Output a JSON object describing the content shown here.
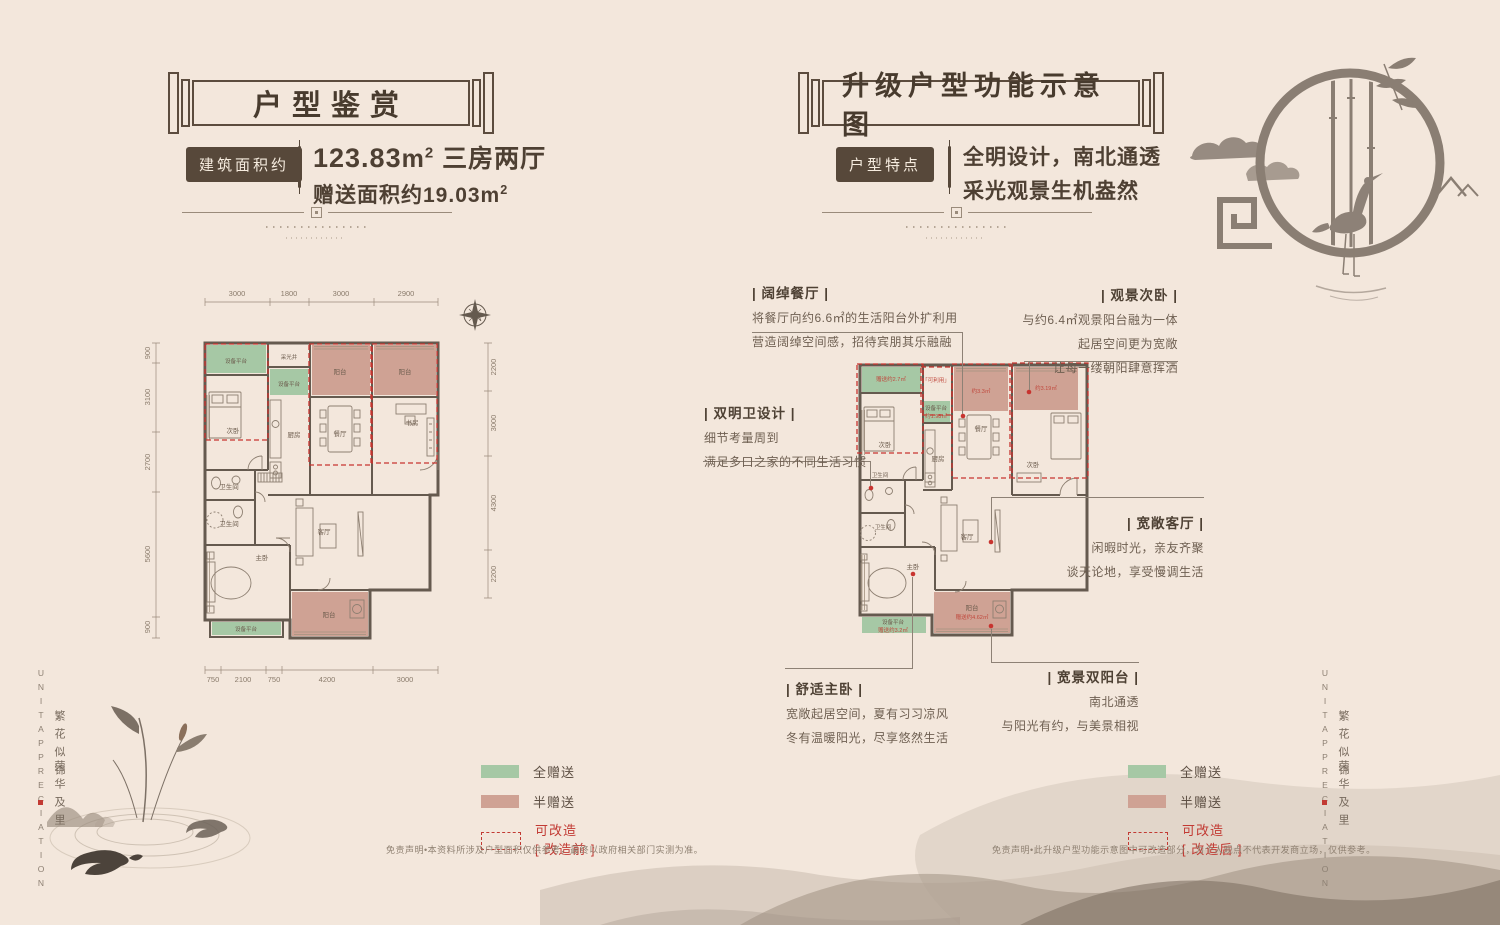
{
  "colors": {
    "background": "#f3e7dc",
    "accent_red": "#c23a33",
    "gift_green": "#a6c8a5",
    "gift_pink": "#cfa294",
    "dark_brown": "#554637"
  },
  "side_left": {
    "en": "UNITAPPRECIATION",
    "cn_top": "繁花似锦",
    "cn_bottom": "荣华及里"
  },
  "side_right": {
    "en": "UNITAPPRECIATION",
    "cn_top": "繁花似锦",
    "cn_bottom": "荣华及里"
  },
  "left_panel": {
    "banner_title": "户型鉴赏",
    "info": {
      "label": "建筑面积约",
      "area_value": "123.83",
      "area_unit": "m",
      "area_sup": "2",
      "area_rest": "三房两厅",
      "gift_line": "赠送面积约19.03m",
      "gift_sup": "2"
    },
    "plan": {
      "dims_top": [
        "3000",
        "1800",
        "3000",
        "2900"
      ],
      "dims_bottom": [
        "750",
        "2100",
        "750",
        "4200",
        "3000"
      ],
      "dims_left": [
        "900",
        "3100",
        "2700",
        "5600",
        "900"
      ],
      "dims_right": [
        "2200",
        "3000",
        "4300",
        "2200"
      ],
      "rooms": {
        "equip_top": "设备平台",
        "skylight": "采光井",
        "equip_mid": "设备平台",
        "balcony_center": "阳台",
        "balcony_right": "阳台",
        "bedroom2": "次卧",
        "kitchen": "厨房",
        "dining": "餐厅",
        "study": "书房",
        "bath_upper": "卫生间",
        "bath_lower": "卫生间",
        "master": "主卧",
        "living": "客厅",
        "balcony_bottom": "阳台",
        "equip_bottom": "设备平台"
      }
    },
    "legend": {
      "full": "全赠送",
      "half": "半赠送",
      "mod": "可改造",
      "mod_state": "[ 改造前 ]"
    },
    "disclaimer": "免责声明•本资料所涉及户型面积仅供参考，最终以政府相关部门实测为准。"
  },
  "right_panel": {
    "banner_title": "升级户型功能示意图",
    "info": {
      "label": "户型特点",
      "line1": "全明设计，南北通透",
      "line2": "采光观景生机盎然"
    },
    "plan": {
      "rooms": {
        "gift_27": "赠送约2.7㎡",
        "usable": "「可利用」",
        "equip": "设备平台",
        "equip_area": "约1.98㎡",
        "kitchen": "厨房",
        "dining_gift": "约3.3㎡",
        "dining": "餐厅",
        "bedroom2_left": "次卧",
        "bedroom2_gift": "约3.19㎡",
        "bedroom2_right": "次卧",
        "bath_upper": "卫生间",
        "bath_lower": "卫生间",
        "master": "主卧",
        "living": "客厅",
        "balcony": "阳台",
        "balcony_gift": "赠送约4.62㎡",
        "equip_bottom": "设备平台",
        "equip_bottom_gift": "赠送约3.2㎡"
      }
    },
    "annotations": {
      "dining": {
        "title": "| 阔绰餐厅 |",
        "line1": "将餐厅向约6.6㎡的生活阳台外扩利用",
        "line2": "营造阔绰空间感，招待宾朋其乐融融"
      },
      "bedroom": {
        "title": "| 观景次卧 |",
        "line1": "与约6.4㎡观景阳台融为一体",
        "line2": "起居空间更为宽敞",
        "line3": "让每一缕朝阳肆意挥洒"
      },
      "bath": {
        "title": "| 双明卫设计 |",
        "line1": "细节考量周到",
        "line2": "满足多口之家的不同生活习惯"
      },
      "living": {
        "title": "| 宽敞客厅 |",
        "line1": "闲暇时光，亲友齐聚",
        "line2": "谈天论地，享受慢调生活"
      },
      "master": {
        "title": "| 舒适主卧 |",
        "line1": "宽敞起居空间，夏有习习凉风",
        "line2": "冬有温暖阳光，尽享悠然生活"
      },
      "balcony": {
        "title": "| 宽景双阳台 |",
        "line1": "南北通透",
        "line2": "与阳光有约，与美景相视"
      }
    },
    "legend": {
      "full": "全赠送",
      "half": "半赠送",
      "mod": "可改造",
      "mod_state": "[ 改造后 ]"
    },
    "disclaimer": "免责声明•此升级户型功能示意图中可改造部分，为个人观点不代表开发商立场，仅供参考。"
  }
}
